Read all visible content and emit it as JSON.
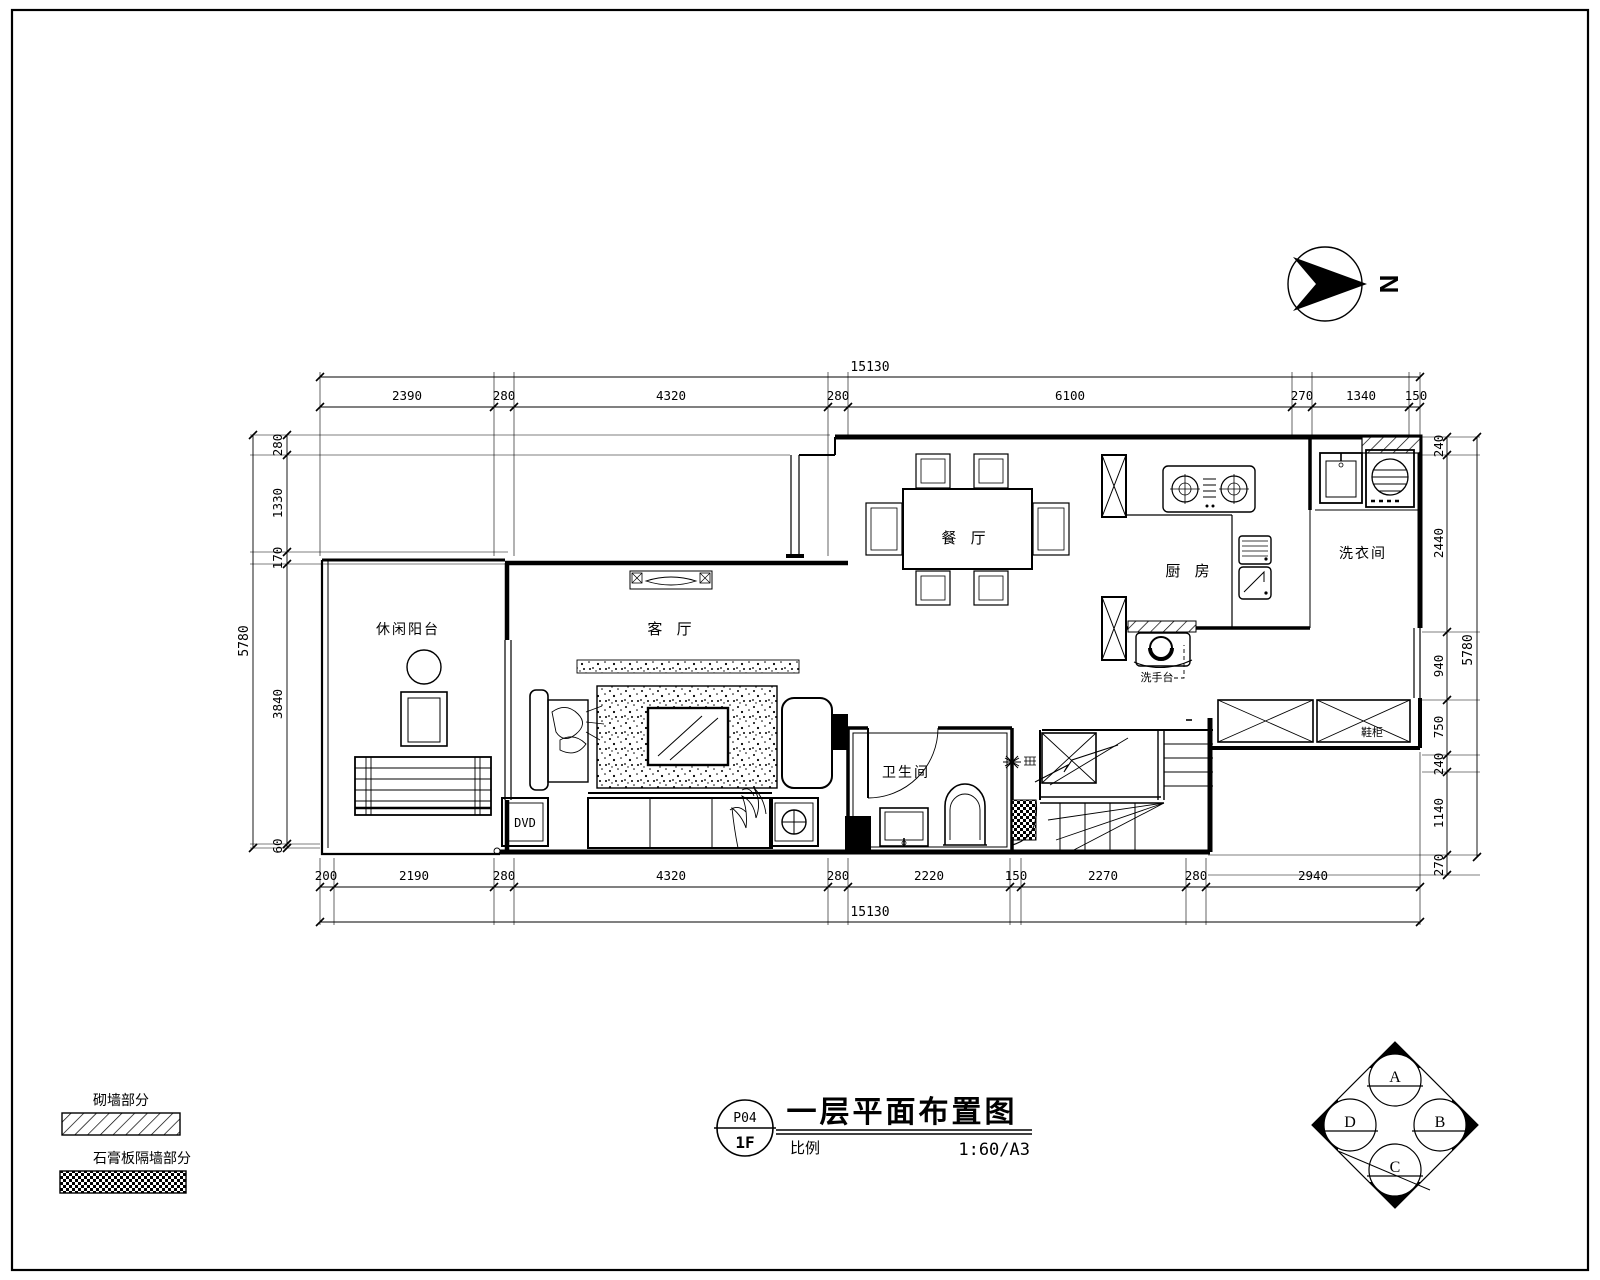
{
  "drawing": {
    "title": "一层平面布置图",
    "sheet_no": "P04",
    "floor": "1F",
    "scale_label": "比例",
    "scale_value": "1:60/A3",
    "north_label": "N"
  },
  "rooms": {
    "balcony": "休闲阳台",
    "living": "客 厅",
    "dining": "餐 厅",
    "kitchen": "厨 房",
    "laundry": "洗衣间",
    "bath": "卫生间"
  },
  "annotations": {
    "shoe_cabinet": "鞋柜",
    "basin": "洗手台",
    "dvd": "DVD"
  },
  "dims": {
    "top": {
      "total": "15130",
      "segs": [
        "2390",
        "280",
        "4320",
        "280",
        "6100",
        "270",
        "1340",
        "150"
      ]
    },
    "bottom": {
      "total": "15130",
      "segs": [
        "200",
        "2190",
        "280",
        "4320",
        "280",
        "2220",
        "150",
        "2270",
        "280",
        "2940"
      ]
    },
    "left": {
      "total": "5780",
      "segs": [
        "280",
        "1330",
        "170",
        "3840",
        "60"
      ]
    },
    "right": {
      "total": "5780",
      "segs": [
        "240",
        "2440",
        "940",
        "750",
        "240",
        "1140",
        "270"
      ]
    }
  },
  "legend": {
    "masonry": "砌墙部分",
    "gypsum": "石膏板隔墙部分"
  },
  "elev": {
    "a": "A",
    "b": "B",
    "c": "C",
    "d": "D"
  },
  "colors": {
    "line": "#000000",
    "background": "#ffffff"
  }
}
